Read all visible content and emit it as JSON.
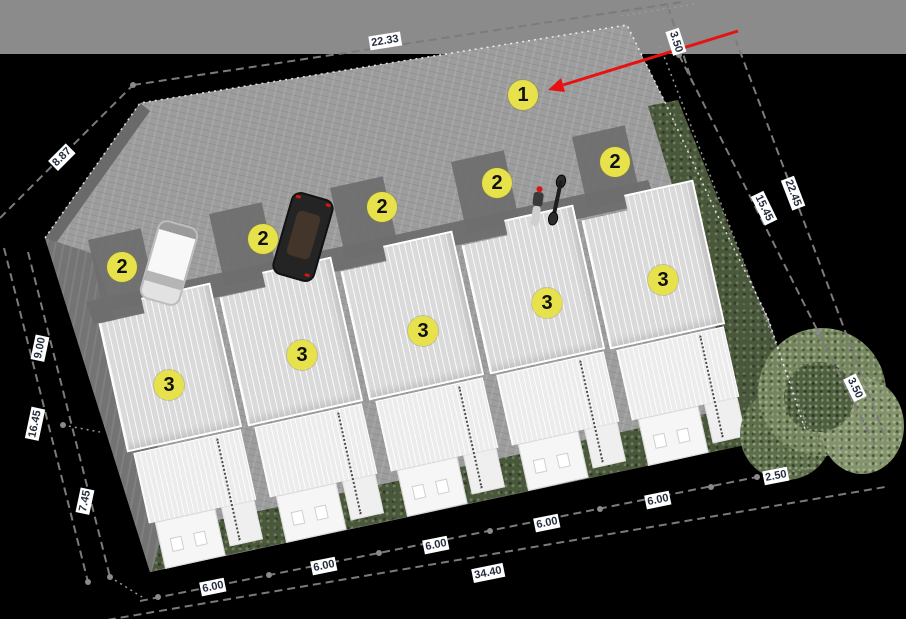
{
  "markers": {
    "m1": {
      "label": "1"
    },
    "m2_1": {
      "label": "2"
    },
    "m2_2": {
      "label": "2"
    },
    "m2_3": {
      "label": "2"
    },
    "m2_4": {
      "label": "2"
    },
    "m2_5": {
      "label": "2"
    },
    "m3_1": {
      "label": "3"
    },
    "m3_2": {
      "label": "3"
    },
    "m3_3": {
      "label": "3"
    },
    "m3_4": {
      "label": "3"
    },
    "m3_5": {
      "label": "3"
    }
  },
  "dimensions": {
    "top_edge": "22.33",
    "top_right_offset": "3.50",
    "left_bevel": "8.87",
    "left_segment_a": "9.00",
    "left_total": "16.45",
    "left_segment_b": "7.45",
    "right_inner": "15.45",
    "right_outer": "22.45",
    "right_lower_offset": "3.50",
    "rear_offset": "2.50",
    "unit_width_1": "6.00",
    "unit_width_2": "6.00",
    "unit_width_3": "6.00",
    "unit_width_4": "6.00",
    "unit_width_5": "6.00",
    "bottom_total": "34.40"
  },
  "colors": {
    "marker_fill": "#e7e24c",
    "marker_text": "#111111",
    "arrow_red": "#e81111",
    "label_bg": "#ffffff",
    "label_text": "#252e3e",
    "dash_gray": "#7b7b7b",
    "boundary_white": "#ffffff",
    "road_gray": "#8b8b8b",
    "asphalt_gray": "#9d9d9d",
    "asphalt_shadow": "#6e6e6e",
    "driveway_dark": "#747474",
    "roof_light": "#dadada",
    "roof_lower": "#ececec",
    "lawn_green": "#49573b",
    "tree_green": "#75865e",
    "background_black": "#000000"
  }
}
